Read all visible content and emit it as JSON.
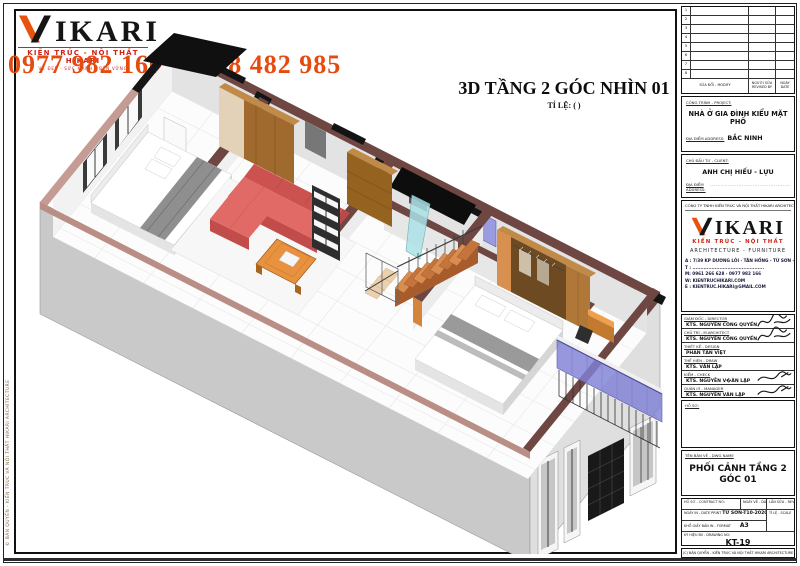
{
  "watermark": {
    "brand": "IKARI",
    "subtitle": "KIẾN TRÚC - NỘI THẤT HIKARI",
    "tagline": "VẺ ĐẸP - SỨC MẠNH - BỀN VỮNG",
    "phone": "0977 982 166 / 0988 482 985"
  },
  "view": {
    "title": "3D TẦNG 2 GÓC NHÌN 01",
    "scale": "TỈ LỆ: ( )"
  },
  "side_note": "© BẢN QUYỀN - KIẾN TRÚC VÀ NỘI THẤT HIKARI ARCHITECTURE",
  "titleblock": {
    "revision": {
      "numbers": [
        "1",
        "2",
        "3",
        "4",
        "5",
        "6",
        "7",
        "8"
      ],
      "modify_label": "SỬA ĐỔI - MODIFY",
      "revised_label": "NGƯỜI SỬA REVISED BY",
      "date_label": "NGÀY DATE"
    },
    "project": {
      "label": "CÔNG TRÌNH - PROJECT:",
      "name": "NHÀ Ở GIA ĐÌNH KIỂU MẶT PHỐ",
      "address_label": "ĐỊA ĐIỂM ADDRESS:",
      "address": "BẮC NINH"
    },
    "client": {
      "label": "CHỦ ĐẦU TƯ - CLIENT:",
      "name": "ANH CHỊ HIẾU - LỰU",
      "address_label": "ĐỊA ĐIỂM ADDRESS:",
      "address": "............................................."
    },
    "company": {
      "fullname": "CÔNG TY TNHH KIẾN TRÚC VÀ NỘI THẤT HIKARI ARCHITECTURE",
      "brand": "IKARI",
      "brand_sub": "KIẾN TRÚC - NỘI THẤT",
      "fields": "ARCHITECTURE   -   FURNITURE",
      "address": "A : 7/39 KP DƯƠNG LÔI - TÂN HỒNG - TỪ SƠN - BN",
      "tel": "T : .............................................",
      "mobile": "M: 0961 266 628 - 0977 982 166",
      "web": "W: KIENTRUCHIKARI.COM",
      "email": "E : KIENTRUC.HIKARI@GMAIL.COM"
    },
    "signatures": [
      {
        "label": "GIÁM ĐỐC - DIRECTOR",
        "name": "KTS. NGUYỄN CÔNG QUYỀN"
      },
      {
        "label": "CHỦ TRÌ - M.ARCHITECT",
        "name": "KTS. NGUYỄN CÔNG QUYỀN"
      },
      {
        "label": "THIẾT KẾ - DESIGN",
        "name": "PHAN TẤN VIỆT"
      },
      {
        "label": "THỂ HIỆN - DRAW",
        "name": "KTS. VĂN LẬP"
      },
      {
        "label": "KIỂM - CHECK",
        "name": "KTS. NGUYỄN V�ĂN LẬP"
      },
      {
        "label": "QUẢN LÝ - MANAGER",
        "name": "KTS. NGUYỄN VĂN LẬP"
      }
    ],
    "dossier_label": "HỒ SƠ:",
    "drawing": {
      "label": "TÊN BẢN VẼ - DWG NAME",
      "name": "PHỐI CẢNH TẦNG 2 GÓC 01"
    },
    "meta": {
      "contract_label": "HỒ SƠ - CONTRACT NO:",
      "date_label": "NGÀY VẼ - DATE",
      "rev_label": "LẦN SỬA - REV",
      "print_label": "NGÀY IN - DATE PRINT",
      "print_value": "TỪ SƠN-T10-2020",
      "scale_label": "TỈ LỆ - SCALE",
      "format_label": "KHỔ GIẤY BẢN IN - FORMAT",
      "format_value": "A3",
      "no_label": "KÝ HIỆU BV - DRAWING NO:",
      "no_value": "KT-19"
    },
    "copyright": "(C) BẢN QUYỀN - KIẾN TRÚC VÀ NỘI THẤT HIKARI ARCHITECTURE"
  },
  "colors": {
    "accent_orange": "#e8520f",
    "logo_red": "#cf2318",
    "wall_cap": "#6e4742",
    "slab_pink": "#b98e85",
    "sofa_red": "#e26a66",
    "stair_wood": "#d98d51",
    "glass_purple": "#8585d6",
    "furniture_orange": "#e8913e"
  }
}
